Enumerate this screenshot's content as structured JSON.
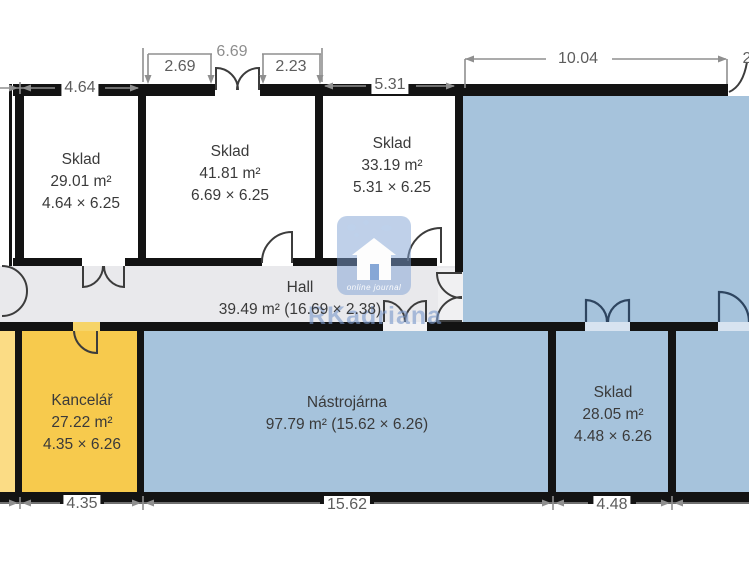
{
  "plan": {
    "rooms": [
      {
        "name": "Sklad",
        "area": "29.01 m²",
        "dims": "4.64 × 6.25"
      },
      {
        "name": "Sklad",
        "area": "41.81 m²",
        "dims": "6.69 × 6.25"
      },
      {
        "name": "Sklad",
        "area": "33.19 m²",
        "dims": "5.31 × 6.25"
      },
      {
        "name": "Hall",
        "area": "39.49 m² (16.69 × 2.38)"
      },
      {
        "name": "Kancelář",
        "area": "27.22 m²",
        "dims": "4.35 × 6.26"
      },
      {
        "name": "Nástrojárna",
        "area": "97.79 m² (15.62 × 6.26)"
      },
      {
        "name": "Sklad",
        "area": "28.05 m²",
        "dims": "4.48 × 6.26"
      }
    ],
    "dimensions": {
      "top": {
        "d464": "4.64",
        "d269": "2.69",
        "d669": "6.69",
        "d223": "2.23",
        "d531": "5.31",
        "d1004": "10.04",
        "partial": "2"
      },
      "bottom": {
        "d435": "4.35",
        "d1562": "15.62",
        "d448": "4.48"
      }
    },
    "watermark": {
      "tagline": "online journal",
      "brand": "RKadriana"
    },
    "colors": {
      "storage_blue": "#a6c3dc",
      "office_yellow": "#f7ca4d",
      "pale_yellow": "#fbdc85",
      "hall_gray": "#e9e9ec",
      "wall": "#131313"
    }
  }
}
